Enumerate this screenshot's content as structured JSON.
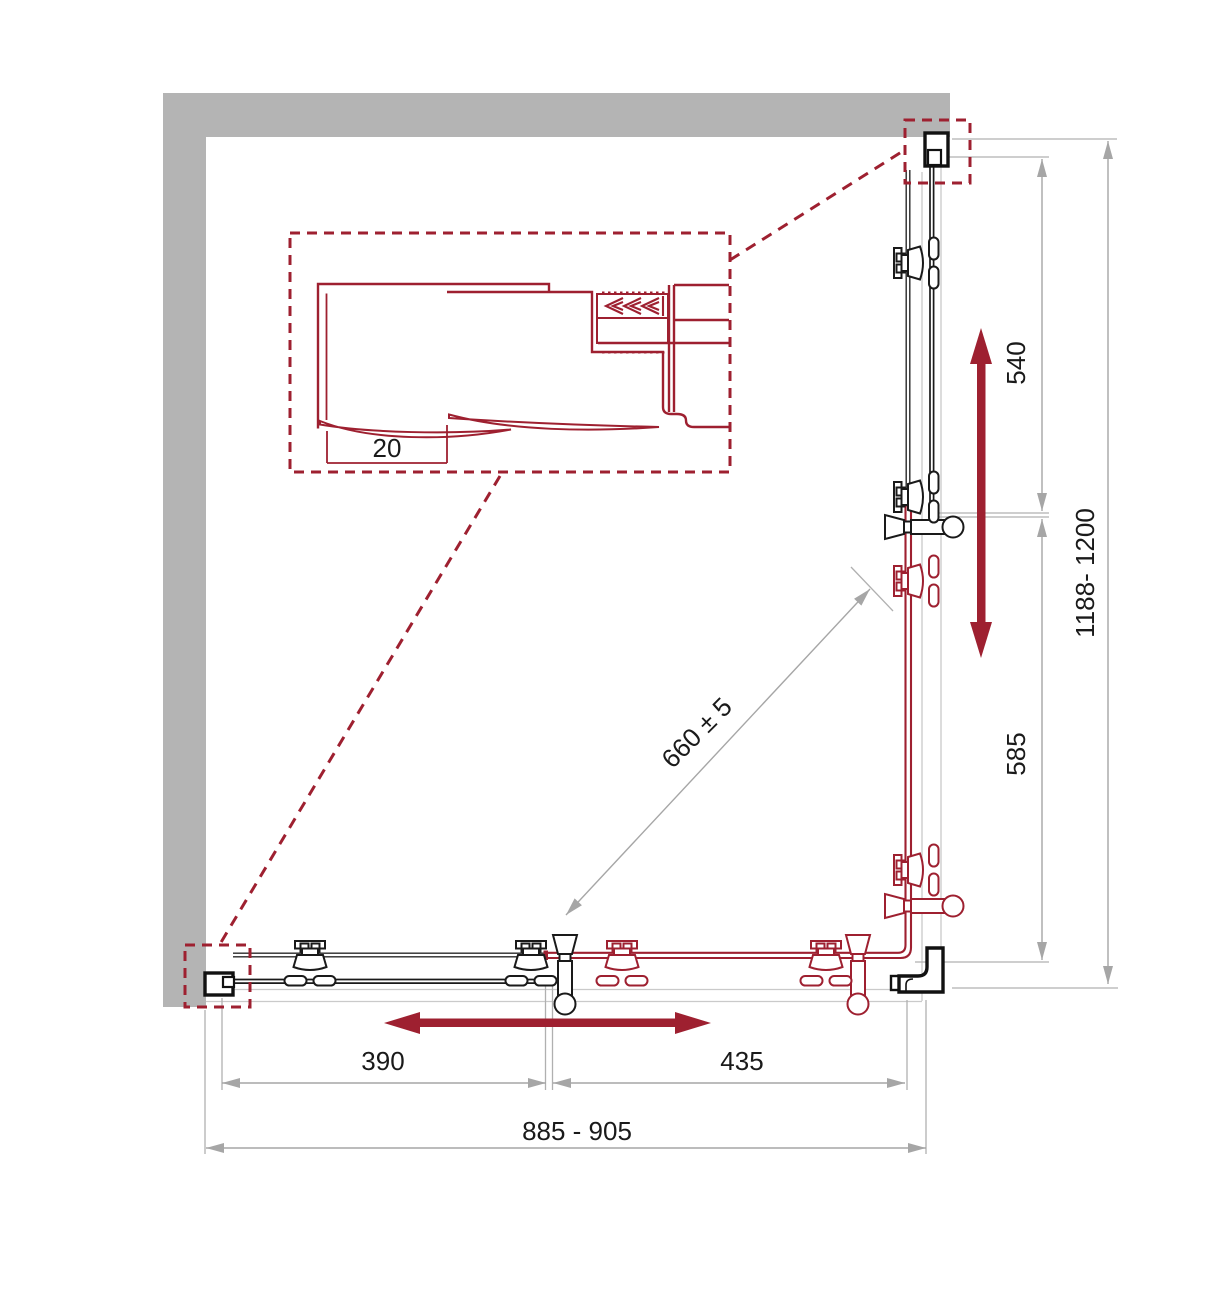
{
  "drawing": {
    "title": "shower-enclosure-corner-installation-plan",
    "labels": {
      "inset_dim": "20",
      "dim_390": "390",
      "dim_435": "435",
      "dim_overall_width": "885 - 905",
      "dim_540": "540",
      "dim_585": "585",
      "dim_overall_height": "1188- 1200",
      "dim_diagonal": "660 ± 5"
    },
    "colors": {
      "accent_red": "#9E2030",
      "wall_gray": "#B4B4B4",
      "dim_gray": "#A6A6A6",
      "tray_gray": "#CACACA",
      "line_black": "#1A1A1A"
    }
  }
}
